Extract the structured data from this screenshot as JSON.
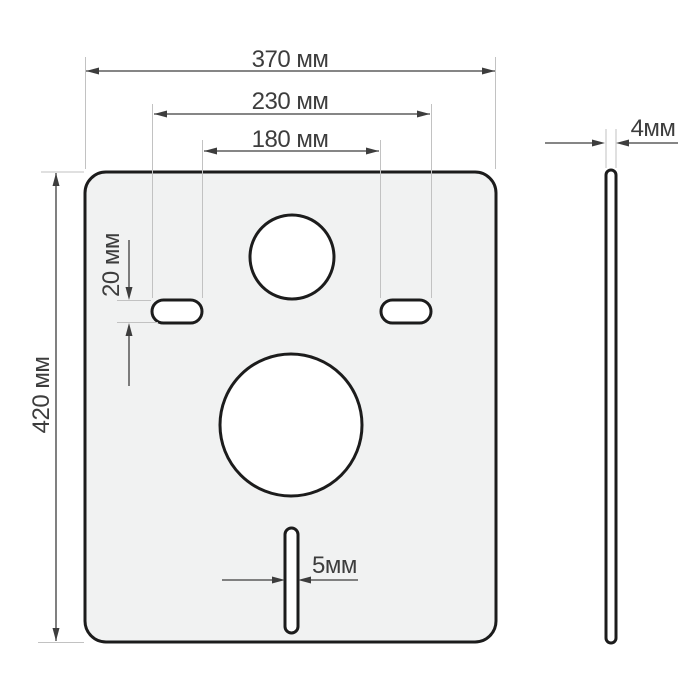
{
  "drawing": {
    "views": {
      "front_view_name": "front-view-plate",
      "side_view_name": "side-view-profile"
    },
    "dimensions": {
      "plate_width": {
        "label": "370 мм",
        "value_mm": 370
      },
      "holes_outer_span": {
        "label": "230 мм",
        "value_mm": 230
      },
      "holes_inner_span": {
        "label": "180 мм",
        "value_mm": 180
      },
      "plate_height": {
        "label": "420 мм",
        "value_mm": 420
      },
      "mount_slot_height": {
        "label": "20 мм",
        "value_mm": 20
      },
      "bottom_slot_width": {
        "label": "5мм",
        "value_mm": 5
      },
      "thickness": {
        "label": "4мм",
        "value_mm": 4
      }
    },
    "colors": {
      "background": "#ffffff",
      "plate_fill": "#f1f2f2",
      "outline": "#1c1c1c",
      "dimension_line": "#3d3d3d",
      "extension_line": "#c2c2c2",
      "label_text": "#3d3d3d"
    }
  }
}
